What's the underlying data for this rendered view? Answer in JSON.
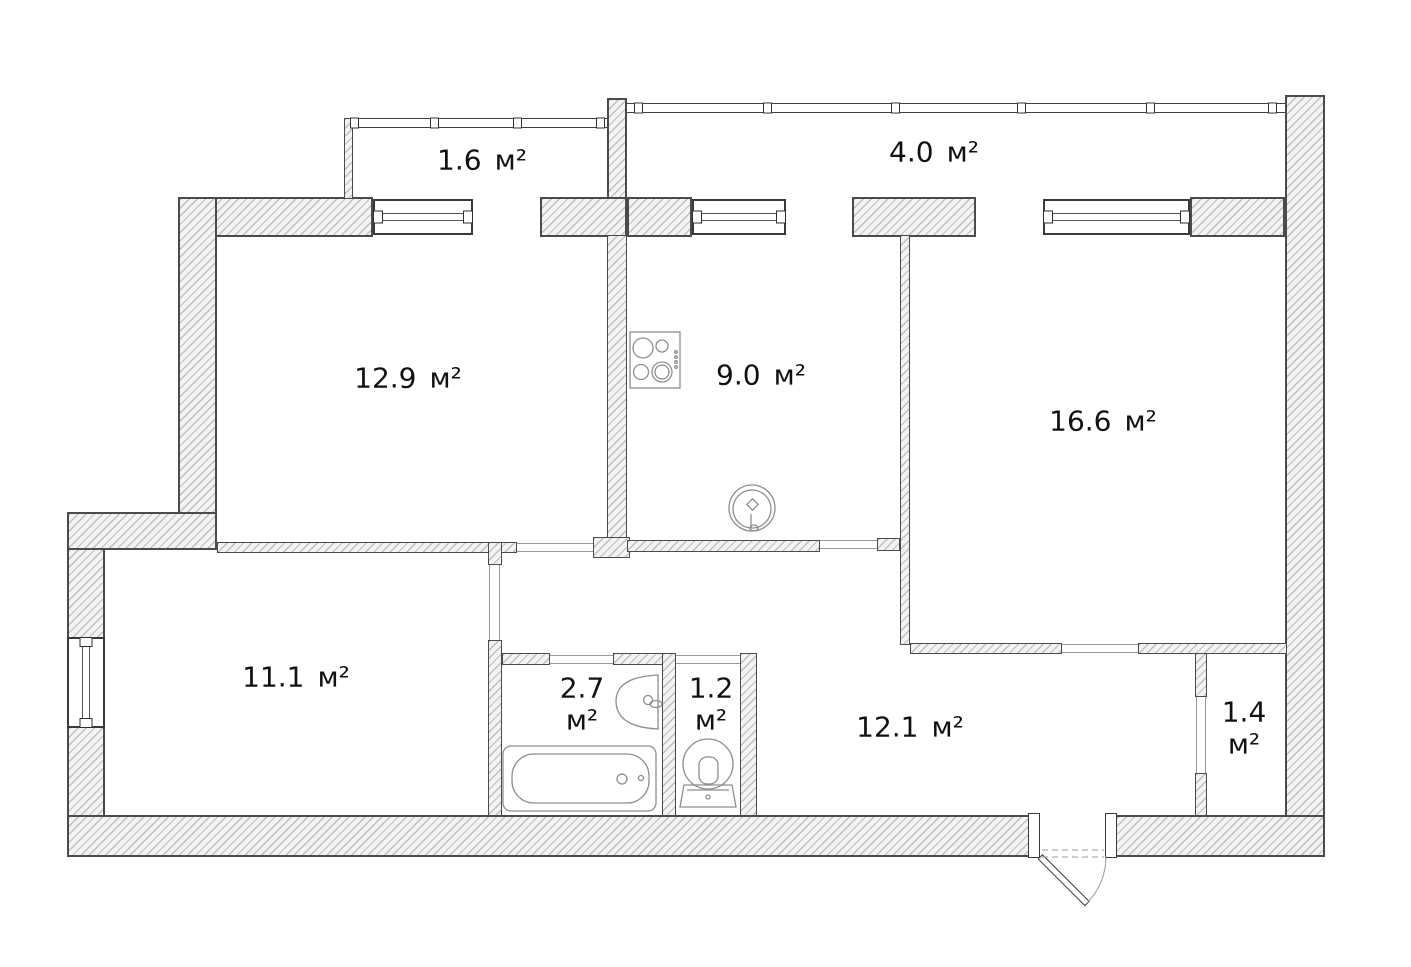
{
  "rooms": [
    {
      "name": "balcony-small",
      "area": "1.6",
      "unit": "м²"
    },
    {
      "name": "balcony-large",
      "area": "4.0",
      "unit": "м²"
    },
    {
      "name": "living-room",
      "area": "12.9",
      "unit": "м²"
    },
    {
      "name": "kitchen",
      "area": "9.0",
      "unit": "м²"
    },
    {
      "name": "bedroom",
      "area": "16.6",
      "unit": "м²"
    },
    {
      "name": "second-room",
      "area": "11.1",
      "unit": "м²"
    },
    {
      "name": "bathroom",
      "area": "2.7",
      "unit": "м²"
    },
    {
      "name": "toilet-room",
      "area": "1.2",
      "unit": "м²"
    },
    {
      "name": "hallway",
      "area": "12.1",
      "unit": "м²"
    },
    {
      "name": "pantry",
      "area": "1.4",
      "unit": "м²"
    }
  ],
  "fixtures": {
    "stove": "stove-icon",
    "kitchen_sink": "kitchen-sink-icon",
    "washbasin": "washbasin-icon",
    "bathtub": "bathtub-icon",
    "toilet": "toilet-icon",
    "entrance_door": "entrance-door"
  },
  "colors": {
    "wall_border": "#4b4b4b",
    "hatch_line": "#bfbfbf",
    "wall_fill": "#f3f3f3",
    "fixture_stroke": "#8e8e8e",
    "thin_line": "#9a9a9a",
    "text": "#111111",
    "background": "#ffffff"
  }
}
